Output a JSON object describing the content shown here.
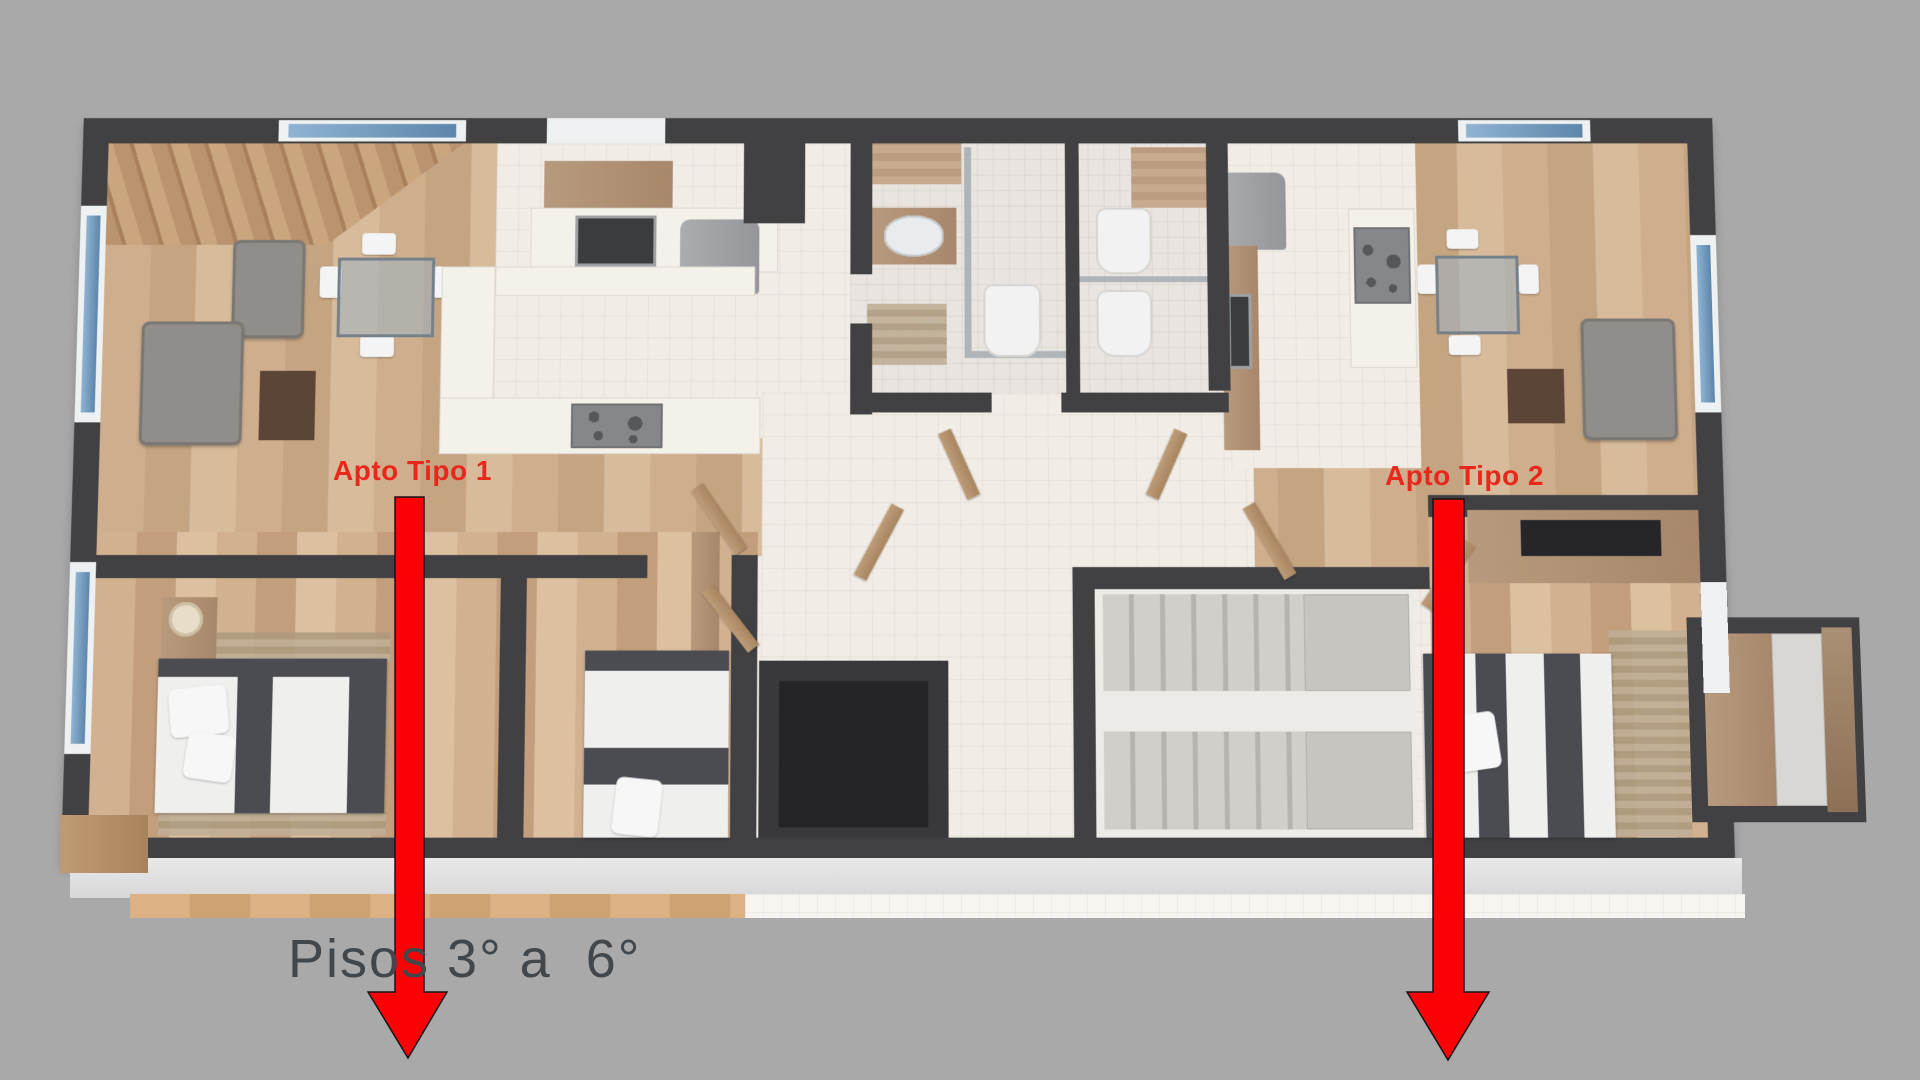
{
  "page": {
    "background_color": "#a9a9a9",
    "description_of_render": "3d-floor-plan-top-view"
  },
  "annotations": {
    "apartment1_label": "Apto Tipo 1",
    "apartment2_label": "Apto Tipo 2",
    "floors_label": "Pisos 3° a  6°",
    "label_color": "#e8281c",
    "floors_label_color": "#42474b"
  },
  "arrows": {
    "count": 2,
    "direction": "down",
    "fill": "#fb0105",
    "outline": "#161616"
  },
  "floorplan": {
    "colors": {
      "wall": "#414143",
      "wood_floor": "#cbaa89",
      "white_tile": "#f1ece6",
      "bath_tile": "#e9e4df",
      "mosaic_accent": "#c3a68c",
      "concrete_stairs": "#cbc8c4",
      "elevator_shaft": "#272729",
      "window_glass": "#7ea6c8",
      "sofa_gray": "#908d8a",
      "door_wood": "#b2906f",
      "arrow_red": "#fb0105"
    },
    "features": [
      "living-dining-room-apartment-1",
      "kitchen-apartment-1",
      "bathroom-apartment-1",
      "bathroom-apartment-2",
      "kitchen-apartment-2",
      "living-dining-room-apartment-2",
      "bedroom-1-apartment-1",
      "bedroom-2-apartment-1",
      "bedroom-apartment-2",
      "elevator-shaft",
      "switchback-staircase",
      "entry-hall",
      "balcony-deck",
      "wardrobe"
    ]
  }
}
